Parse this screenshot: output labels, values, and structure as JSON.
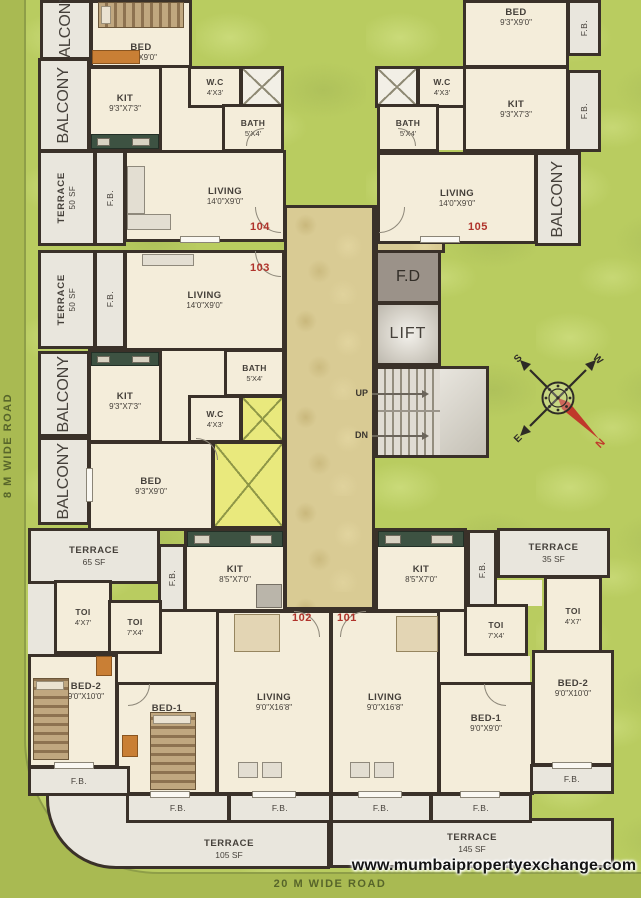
{
  "roads": {
    "left": "8 M WIDE ROAD",
    "bottom": "20 M WIDE ROAD"
  },
  "watermark": "www.mumbaipropertyexchange.com",
  "compass": {
    "north": "N",
    "south": "S",
    "east": "E",
    "west": "W"
  },
  "core": {
    "lift": "LIFT",
    "fire_duct": "F.D",
    "up": "UP",
    "down": "DN"
  },
  "common_labels": {
    "balcony": "BALCONY",
    "fb": "F.B."
  },
  "units": {
    "unit104": {
      "number": "104",
      "bed": {
        "name": "BED",
        "dims": "9'3\"X9'0\""
      },
      "kit": {
        "name": "KIT",
        "dims": "9'3\"X7'3\""
      },
      "wc": {
        "name": "W.C",
        "dims": "4'X3'"
      },
      "bath": {
        "name": "BATH",
        "dims": "5'X4'"
      },
      "living": {
        "name": "LIVING",
        "dims": "14'0\"X9'0\""
      },
      "terrace": {
        "name": "TERRACE",
        "dims": "50 SF"
      }
    },
    "unit105": {
      "number": "105",
      "bed": {
        "name": "BED",
        "dims": "9'3\"X9'0\""
      },
      "kit": {
        "name": "KIT",
        "dims": "9'3\"X7'3\""
      },
      "wc": {
        "name": "W.C",
        "dims": "4'X3'"
      },
      "bath": {
        "name": "BATH",
        "dims": "5'X4'"
      },
      "living": {
        "name": "LIVING",
        "dims": "14'0\"X9'0\""
      }
    },
    "unit103": {
      "number": "103",
      "terrace": {
        "name": "TERRACE",
        "dims": "50 SF"
      },
      "living": {
        "name": "LIVING",
        "dims": "14'0\"X9'0\""
      },
      "kit": {
        "name": "KIT",
        "dims": "9'3\"X7'3\""
      },
      "bath": {
        "name": "BATH",
        "dims": "5'X4'"
      },
      "wc": {
        "name": "W.C",
        "dims": "4'X3'"
      },
      "bed": {
        "name": "BED",
        "dims": "9'3\"X9'0\""
      }
    },
    "unit102": {
      "number": "102",
      "terrace": {
        "name": "TERRACE",
        "dims": "65 SF"
      },
      "kit": {
        "name": "KIT",
        "dims": "8'5\"X7'0\""
      },
      "toi_large": {
        "name": "TOI",
        "dims": "4'X7'"
      },
      "toi_small": {
        "name": "TOI",
        "dims": "7'X4'"
      },
      "bed2": {
        "name": "BED-2",
        "dims": "9'0\"X10'0\""
      },
      "bed1": {
        "name": "BED-1",
        "dims": "9'0\"X9'0\""
      },
      "living": {
        "name": "LIVING",
        "dims": "9'0\"X16'8\""
      }
    },
    "unit101": {
      "number": "101",
      "terrace": {
        "name": "TERRACE",
        "dims": "35 SF"
      },
      "kit": {
        "name": "KIT",
        "dims": "8'5\"X7'0\""
      },
      "toi_large": {
        "name": "TOI",
        "dims": "4'X7'"
      },
      "toi_small": {
        "name": "TOI",
        "dims": "7'X4'"
      },
      "bed2": {
        "name": "BED-2",
        "dims": "9'0\"X10'0\""
      },
      "bed1": {
        "name": "BED-1",
        "dims": "9'0\"X9'0\""
      },
      "living": {
        "name": "LIVING",
        "dims": "9'0\"X16'8\""
      }
    }
  },
  "terraces": {
    "bottom_left": {
      "name": "TERRACE",
      "dims": "105 SF"
    },
    "bottom_right": {
      "name": "TERRACE",
      "dims": "145 SF"
    }
  }
}
